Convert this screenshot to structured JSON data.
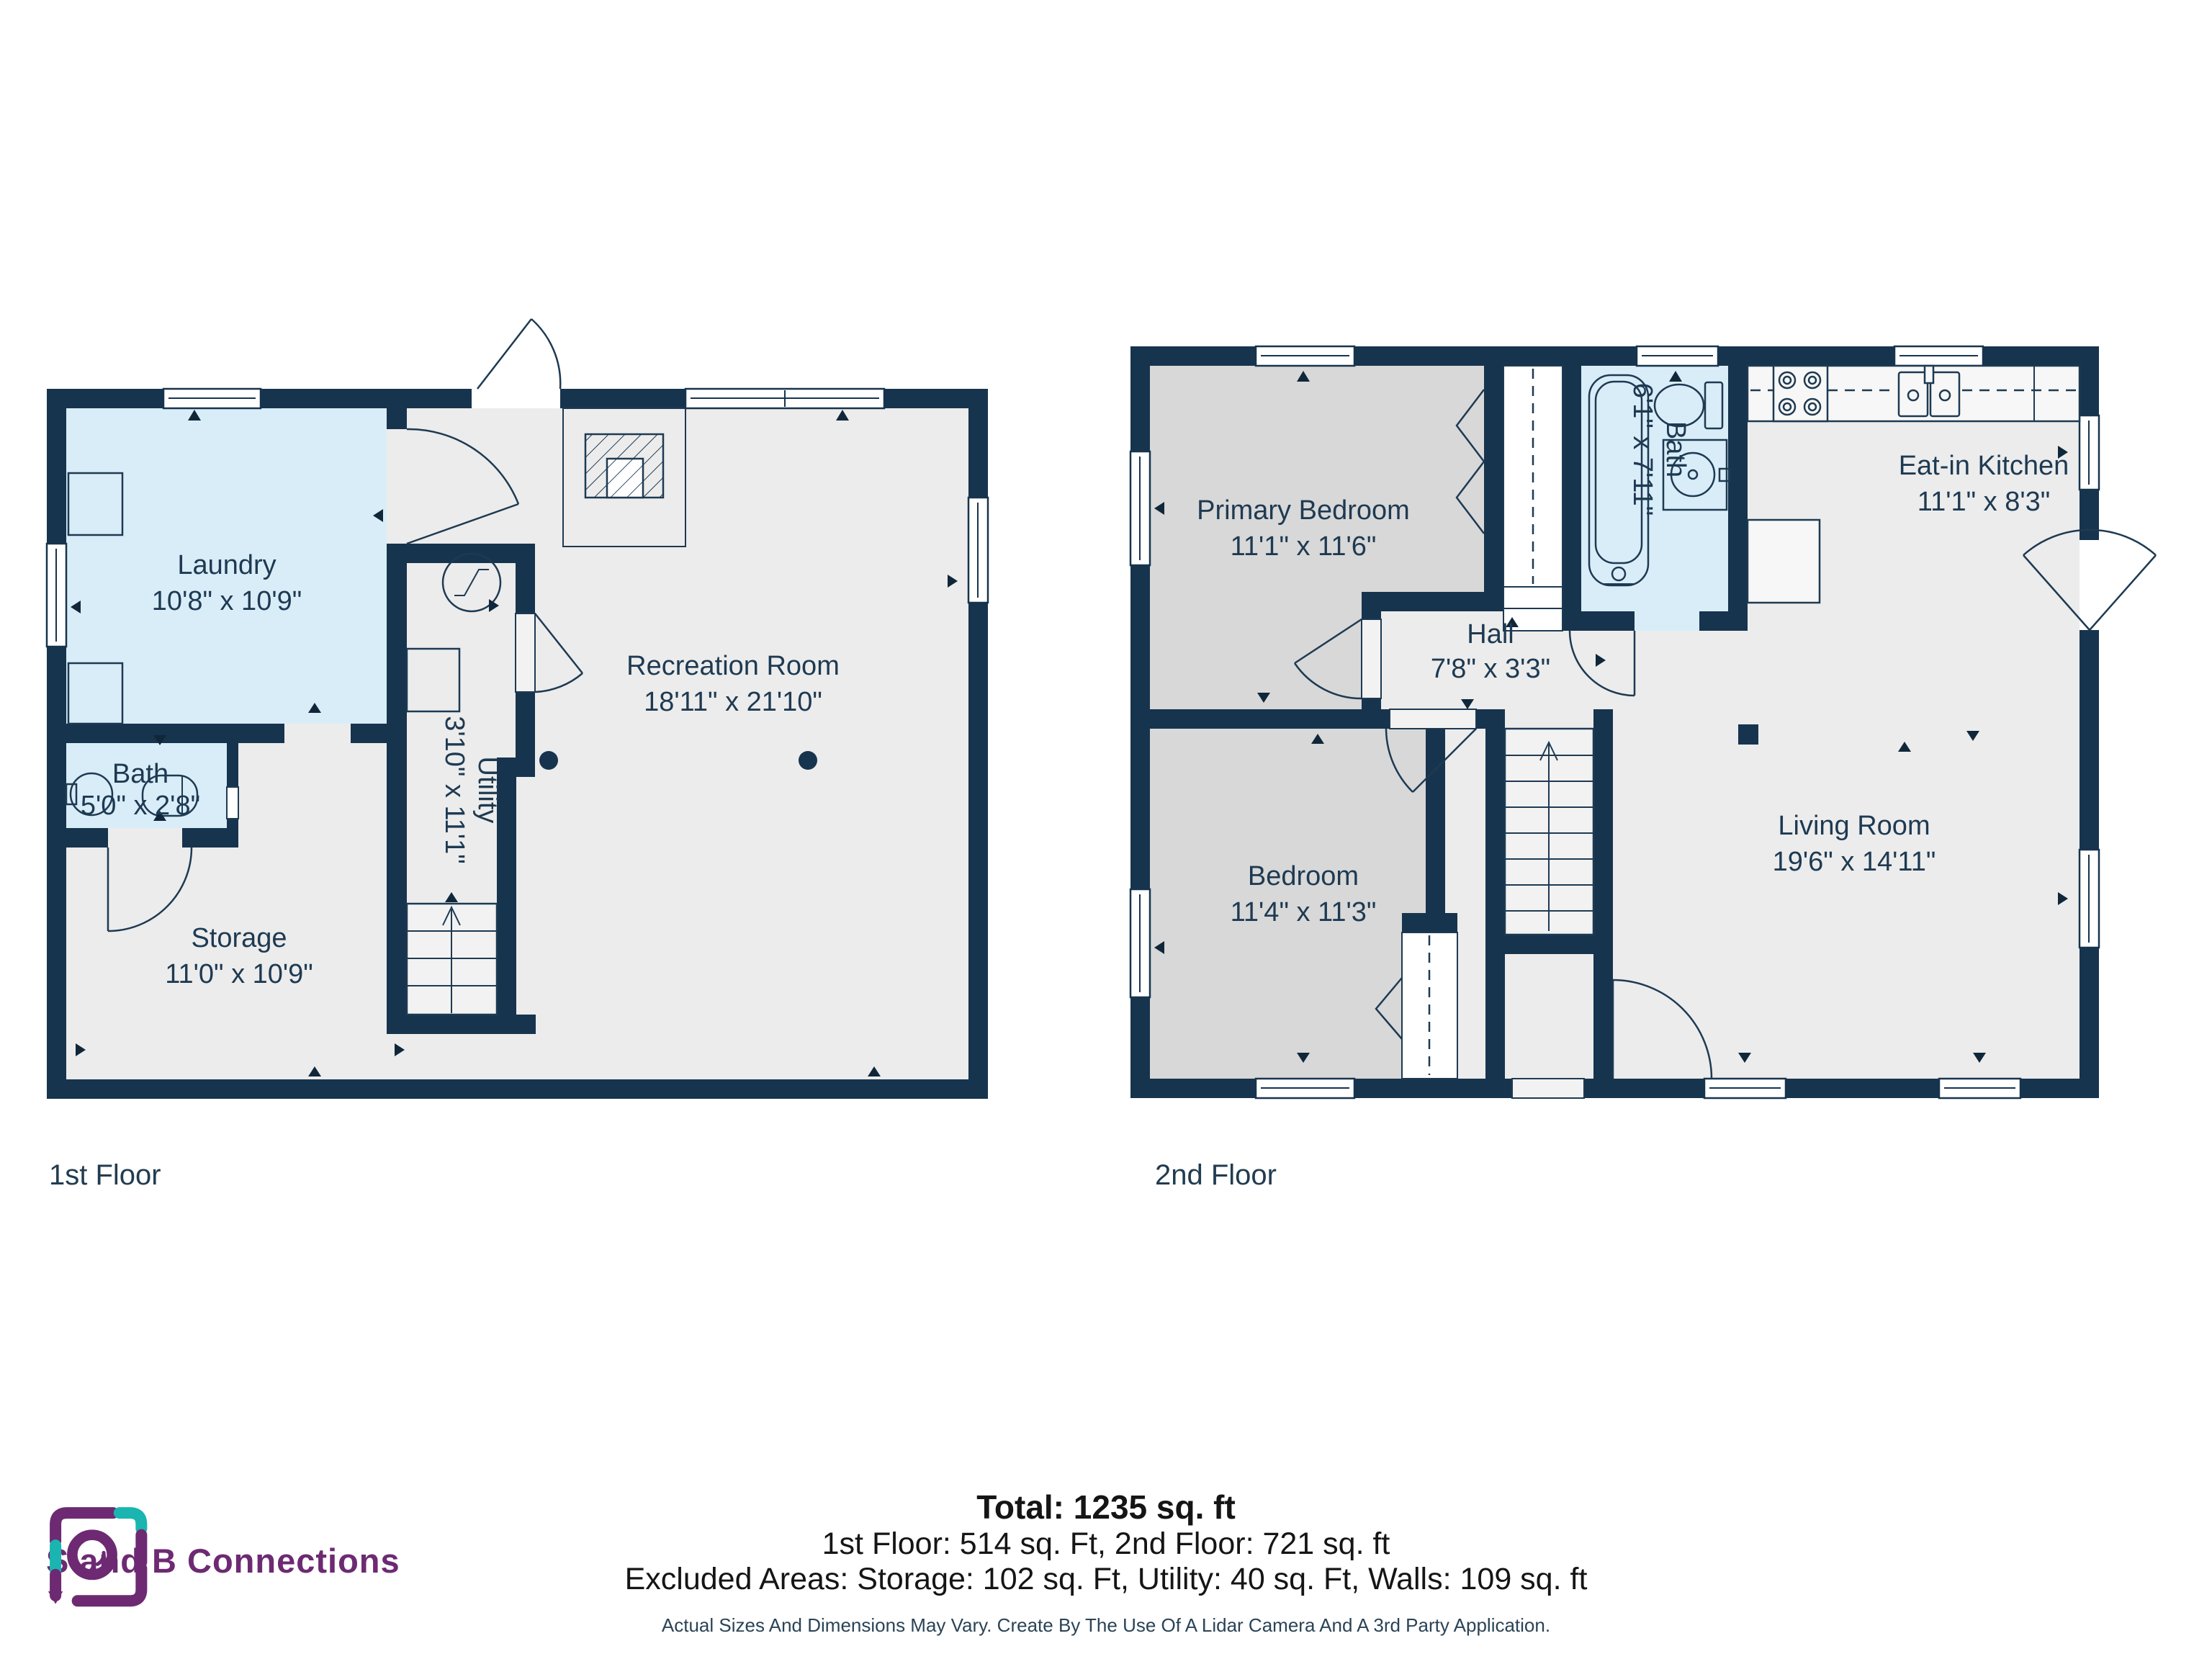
{
  "floors": [
    {
      "label": "1st Floor",
      "rooms": [
        {
          "name": "Laundry",
          "dims": "10'8\" x 10'9\""
        },
        {
          "name": "Bath",
          "dims": "5'0\" x 2'8\""
        },
        {
          "name": "Storage",
          "dims": "11'0\" x 10'9\""
        },
        {
          "name": "Utility",
          "dims": "3'10\" x 11'1\""
        },
        {
          "name": "Recreation Room",
          "dims": "18'11\" x 21'10\""
        }
      ]
    },
    {
      "label": "2nd Floor",
      "rooms": [
        {
          "name": "Primary Bedroom",
          "dims": "11'1\" x 11'6\""
        },
        {
          "name": "Bath",
          "dims": "6'1\" x 7'11\""
        },
        {
          "name": "Eat-in Kitchen",
          "dims": "11'1\" x 8'3\""
        },
        {
          "name": "Hall",
          "dims": "7'8\" x 3'3\""
        },
        {
          "name": "Bedroom",
          "dims": "11'4\" x 11'3\""
        },
        {
          "name": "Living Room",
          "dims": "19'6\" x 14'11\""
        }
      ]
    }
  ],
  "summary": {
    "total": "Total: 1235 sq. ft",
    "floor_totals": "1st Floor: 514 sq. Ft, 2nd Floor: 721 sq. ft",
    "excluded": "Excluded Areas: Storage: 102 sq. Ft, Utility: 40 sq. Ft, Walls: 109 sq. ft",
    "disclaimer": "Actual Sizes And Dimensions May Vary. Create By The Use Of A Lidar Camera And A 3rd Party Application."
  },
  "logo": {
    "name": "S and B Connections"
  },
  "colors": {
    "wall": "#17344e",
    "room_light": "#ececec",
    "room_bedroom": "#d8d8d8",
    "room_wet": "#d9edf9",
    "label_text": "#1e3a52",
    "logo_purple": "#6d2a73",
    "logo_teal": "#1ab5b1"
  }
}
